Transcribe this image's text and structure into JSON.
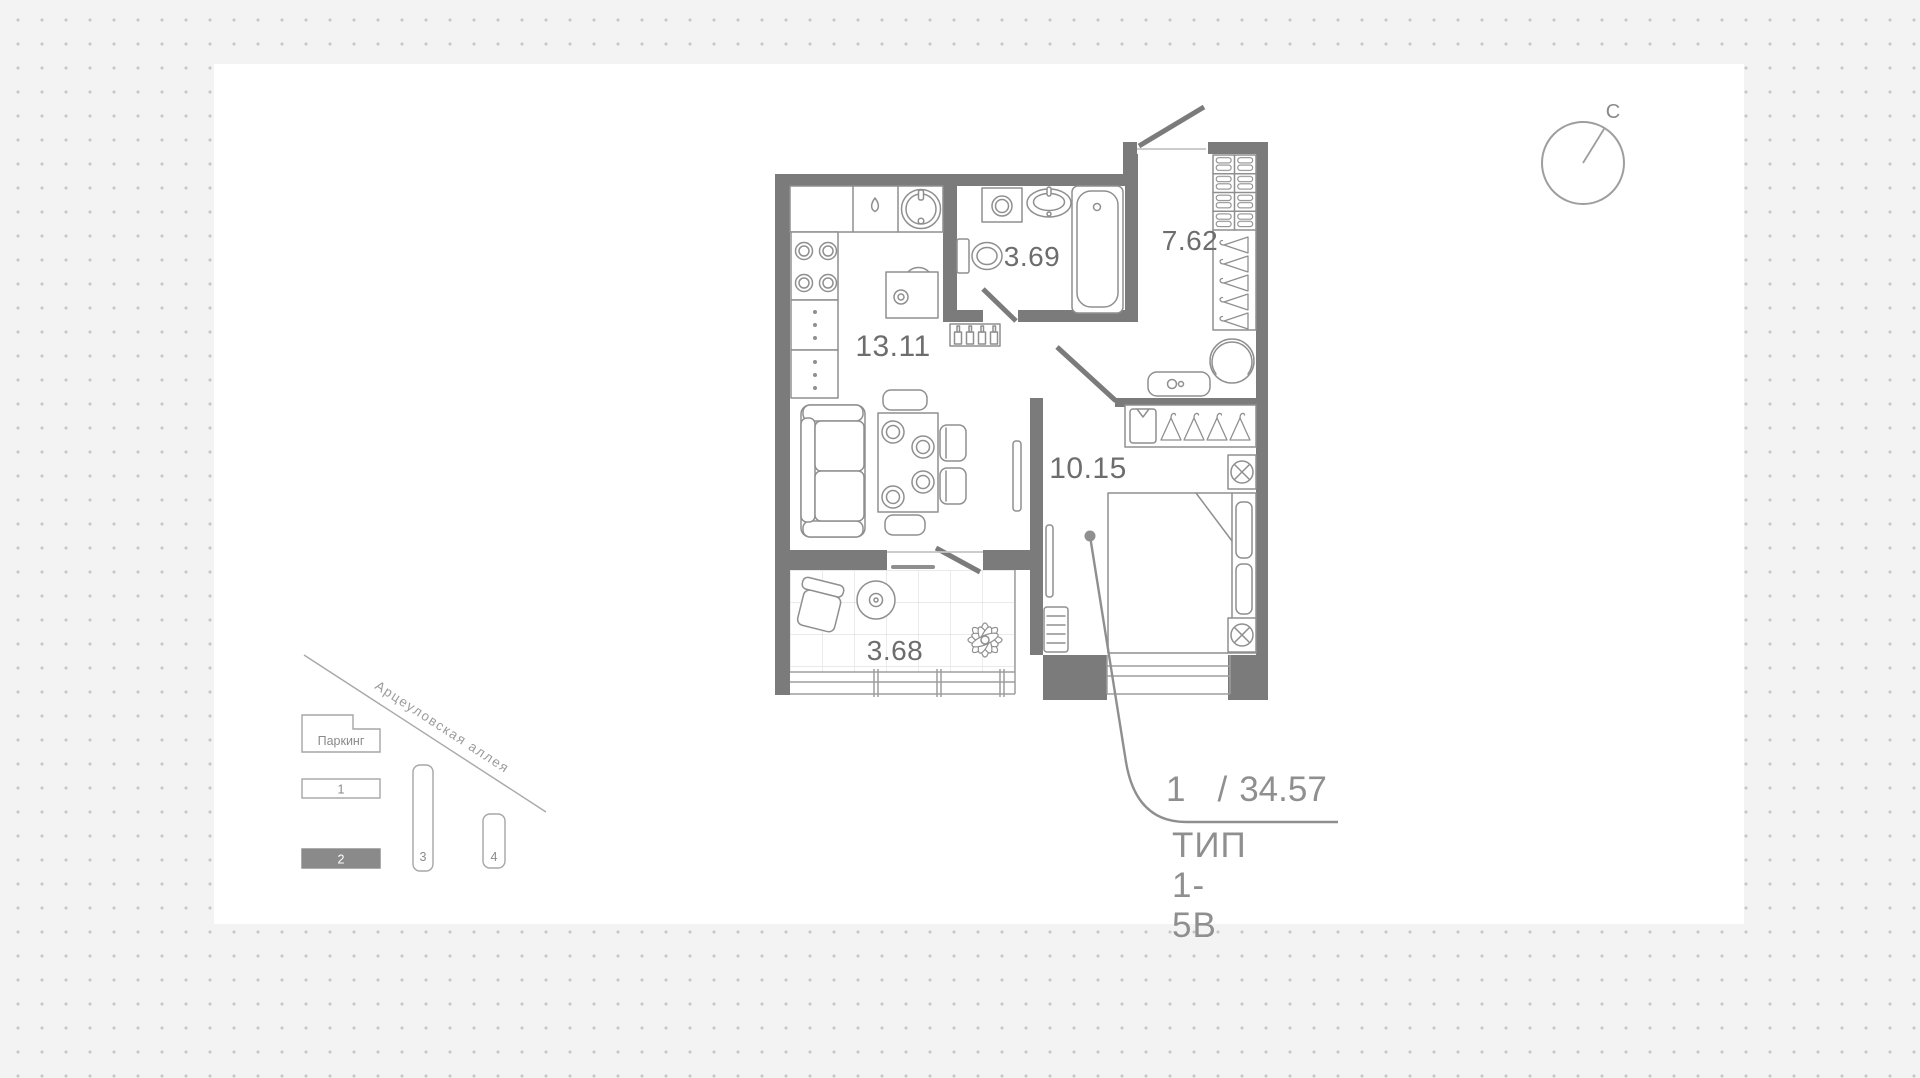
{
  "floor_plan": {
    "rooms": [
      {
        "name": "kitchen-living",
        "area": "13.11"
      },
      {
        "name": "bathroom",
        "area": "3.69"
      },
      {
        "name": "hallway",
        "area": "7.62"
      },
      {
        "name": "bedroom",
        "area": "10.15"
      },
      {
        "name": "balcony",
        "area": "3.68"
      }
    ],
    "callout": {
      "rooms_count": "1",
      "divider": "/",
      "total_area": "34.57",
      "type": "ТИП 1-5В"
    }
  },
  "compass": {
    "north": "С"
  },
  "site_plan": {
    "street": "Арцеуловская аллея",
    "parking": "Паркинг",
    "buildings": [
      {
        "label": "1",
        "selected": false
      },
      {
        "label": "2",
        "selected": true
      },
      {
        "label": "3",
        "selected": false
      },
      {
        "label": "4",
        "selected": false
      }
    ]
  },
  "colors": {
    "wall": "#7b7b7b",
    "furniture_line": "#8f8f8f",
    "area_label": "#6d6d6d",
    "callout_text": "#8f8f8f",
    "selected_building": "#8a8a8a",
    "background": "#f3f3f3",
    "dot": "#c8c8c8"
  }
}
